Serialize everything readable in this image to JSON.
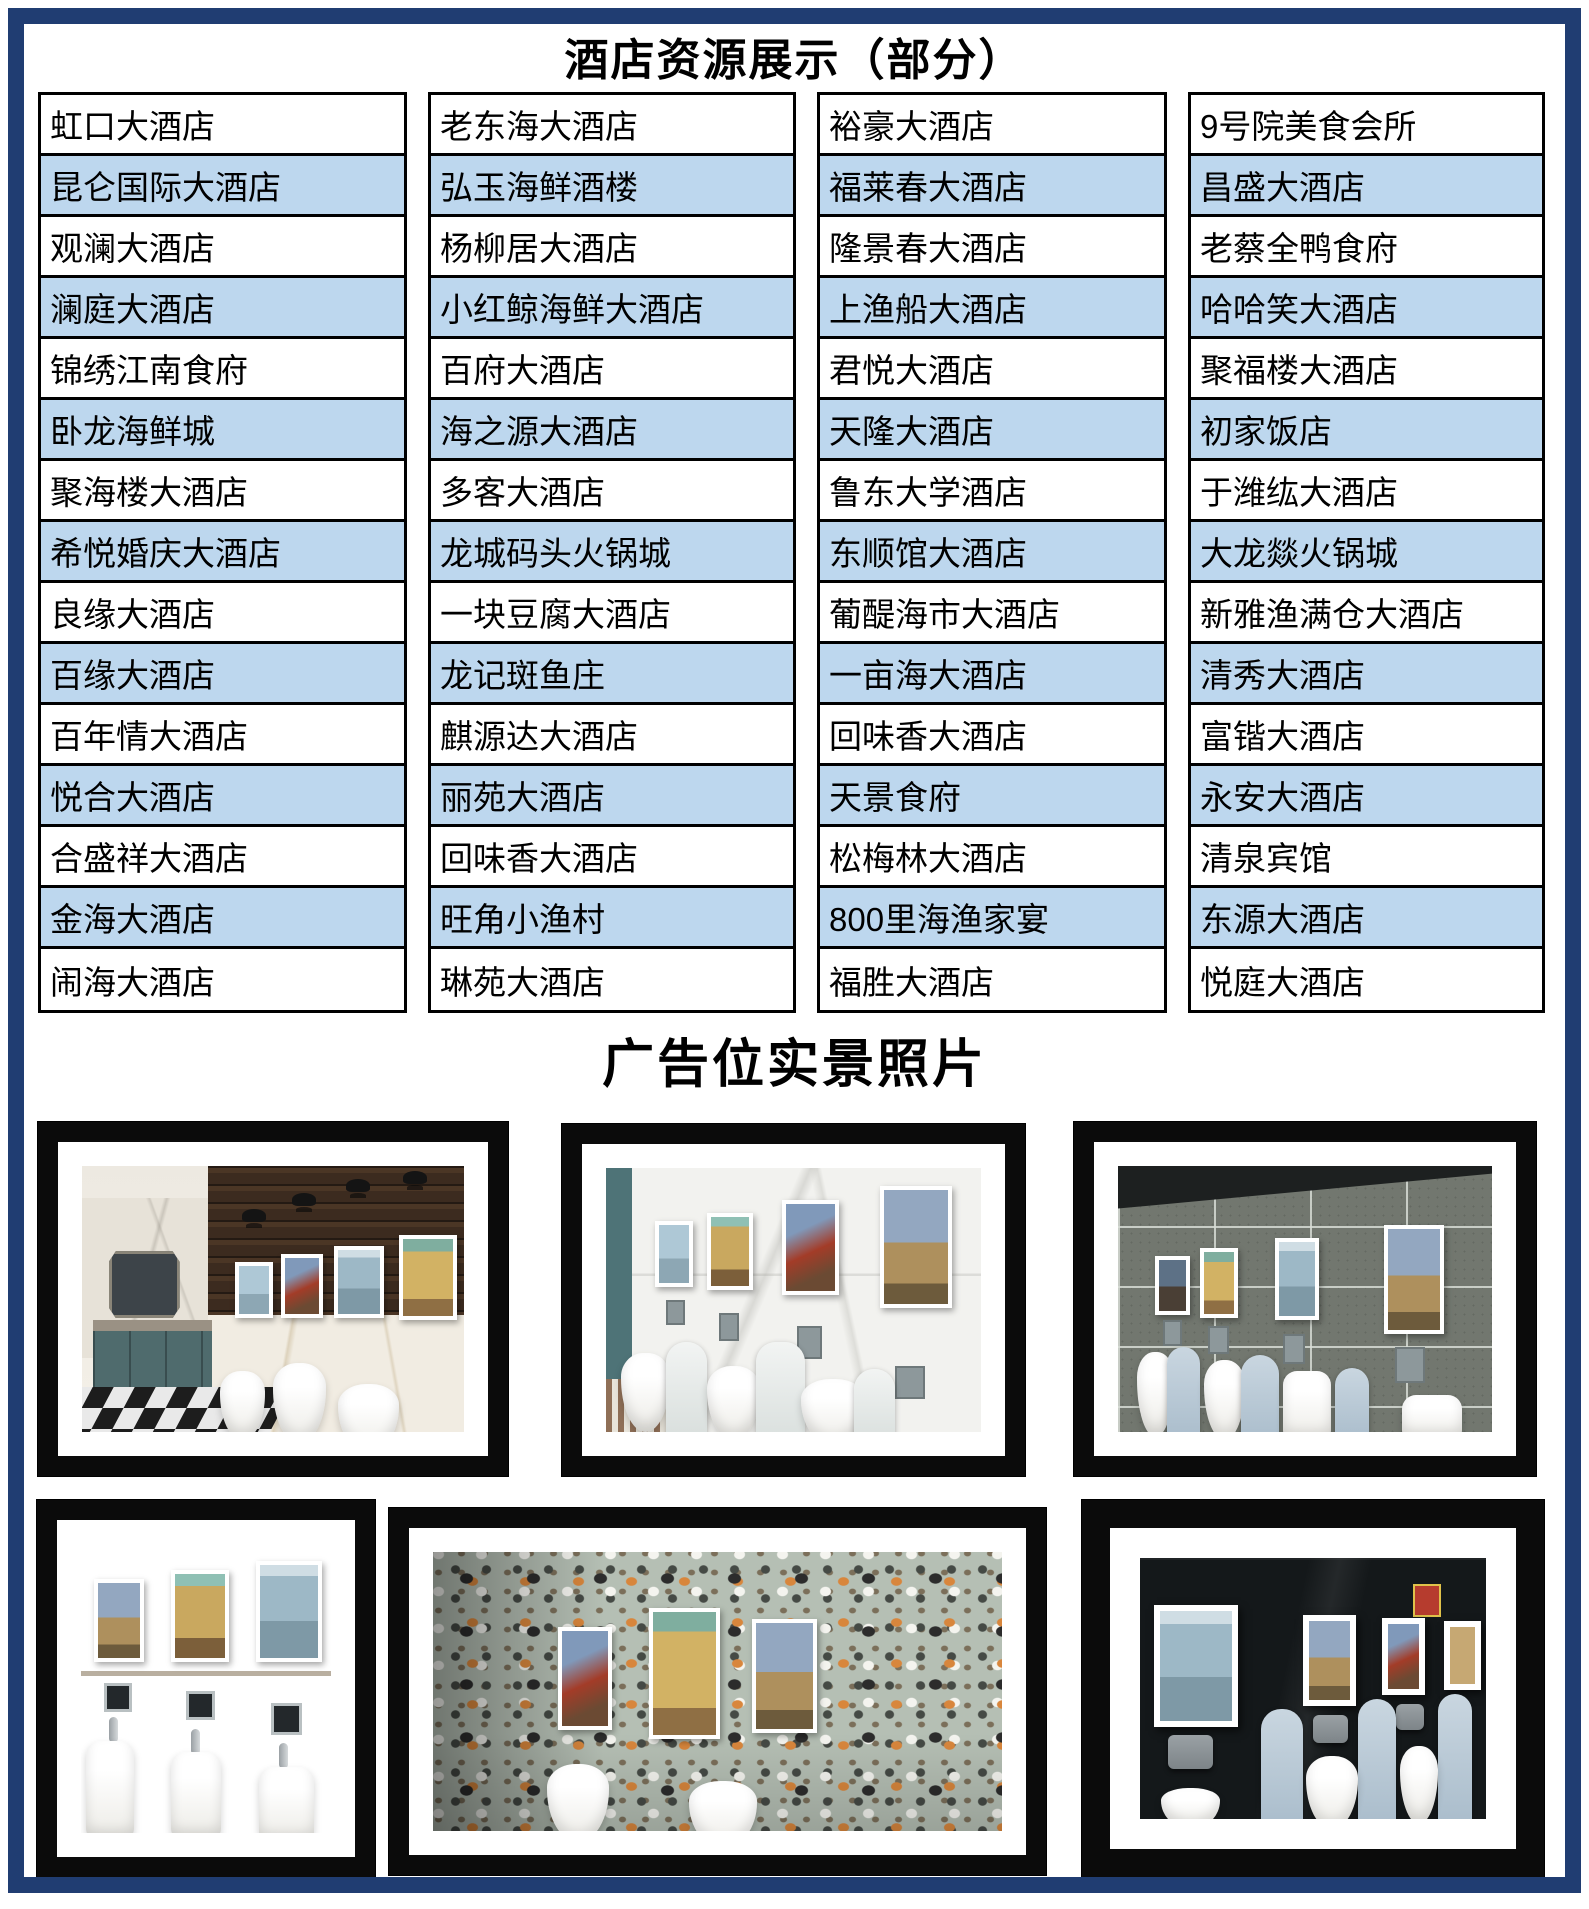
{
  "page": {
    "title": "酒店资源展示（部分）",
    "photos_section_title": "广告位实景照片",
    "border_color": "#203d72",
    "row_alt_color": "#bdd7ee"
  },
  "hotel_table": {
    "columns": [
      [
        "虹口大酒店",
        "昆仑国际大酒店",
        "观澜大酒店",
        "澜庭大酒店",
        "锦绣江南食府",
        "卧龙海鲜城",
        "聚海楼大酒店",
        "希悦婚庆大酒店",
        "良缘大酒店",
        "百缘大酒店",
        "百年情大酒店",
        "悦合大酒店",
        "合盛祥大酒店",
        "金海大酒店",
        "闹海大酒店"
      ],
      [
        "老东海大酒店",
        "弘玉海鲜酒楼",
        "杨柳居大酒店",
        "小红鲸海鲜大酒店",
        "百府大酒店",
        "海之源大酒店",
        "多客大酒店",
        "龙城码头火锅城",
        "一块豆腐大酒店",
        "龙记斑鱼庄",
        "麒源达大酒店",
        "丽苑大酒店",
        "回味香大酒店",
        "旺角小渔村",
        "琳苑大酒店"
      ],
      [
        "裕豪大酒店",
        "福莱春大酒店",
        "隆景春大酒店",
        "上渔船大酒店",
        "君悦大酒店",
        "天隆大酒店",
        "鲁东大学酒店",
        "东顺馆大酒店",
        "葡醍海市大酒店",
        "一亩海大酒店",
        "回味香大酒店",
        "天景食府",
        "松梅林大酒店",
        "800里海渔家宴",
        "福胜大酒店"
      ],
      [
        "9号院美食会所",
        "昌盛大酒店",
        "老蔡全鸭食府",
        "哈哈笑大酒店",
        "聚福楼大酒店",
        "初家饭店",
        "于潍纮大酒店",
        "大龙燚火锅城",
        "新雅渔满仓大酒店",
        "清秀大酒店",
        "富锴大酒店",
        "永安大酒店",
        "清泉宾馆",
        "东源大酒店",
        "悦庭大酒店"
      ]
    ]
  },
  "photos": {
    "items": [
      {
        "description": "restroom with dark wood wall, sconce lamps, four art posters, mirror, teal cabinet, checkered floor, urinals"
      },
      {
        "description": "white marble restroom wall with four framed art posters above three urinals"
      },
      {
        "description": "grey tiled restroom wall with four framed art posters above urinals with pale blue dividers"
      },
      {
        "description": "beige travertine wall with three framed art posters above three boxy urinals with chrome valves"
      },
      {
        "description": "terrazzo wall with framed art posters above two urinals"
      },
      {
        "description": "black granite wall with white-framed art posters, grey flush boxes, urinals with pale blue dividers"
      }
    ]
  }
}
